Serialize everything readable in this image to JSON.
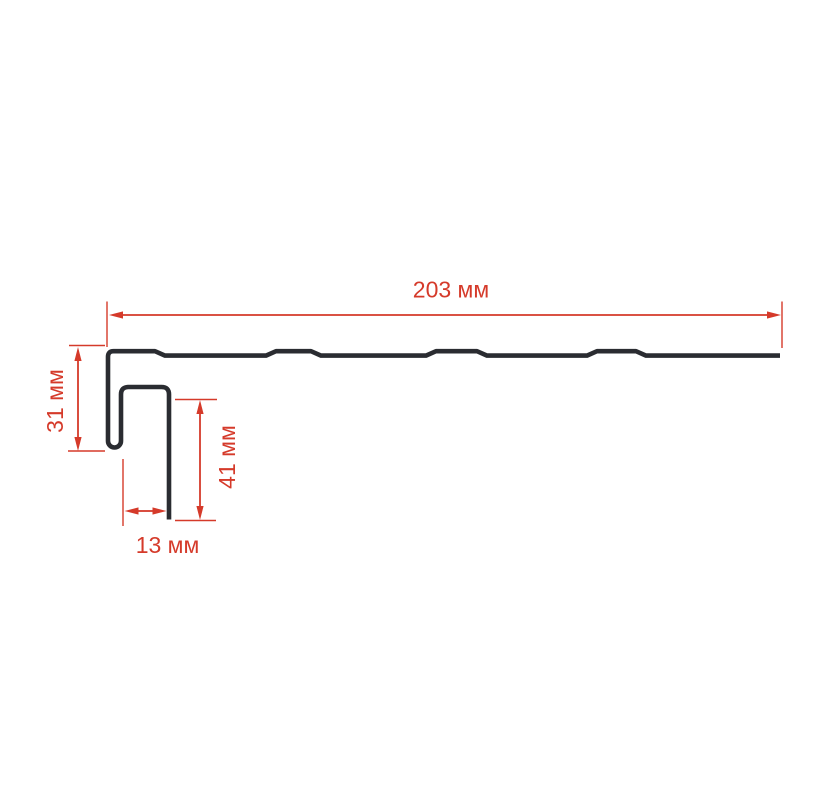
{
  "colors": {
    "accent": "#d53a2a",
    "profile": "#2a2c31",
    "background": "#ffffff"
  },
  "dimensions": {
    "top_width": {
      "value": "203",
      "unit": "мм",
      "label": "203 мм"
    },
    "left_height": {
      "value": "31",
      "unit": "мм",
      "label": "31 мм"
    },
    "hook_depth": {
      "value": "41",
      "unit": "мм",
      "label": "41 мм"
    },
    "channel_width": {
      "value": "13",
      "unit": "мм",
      "label": "13 мм"
    }
  }
}
